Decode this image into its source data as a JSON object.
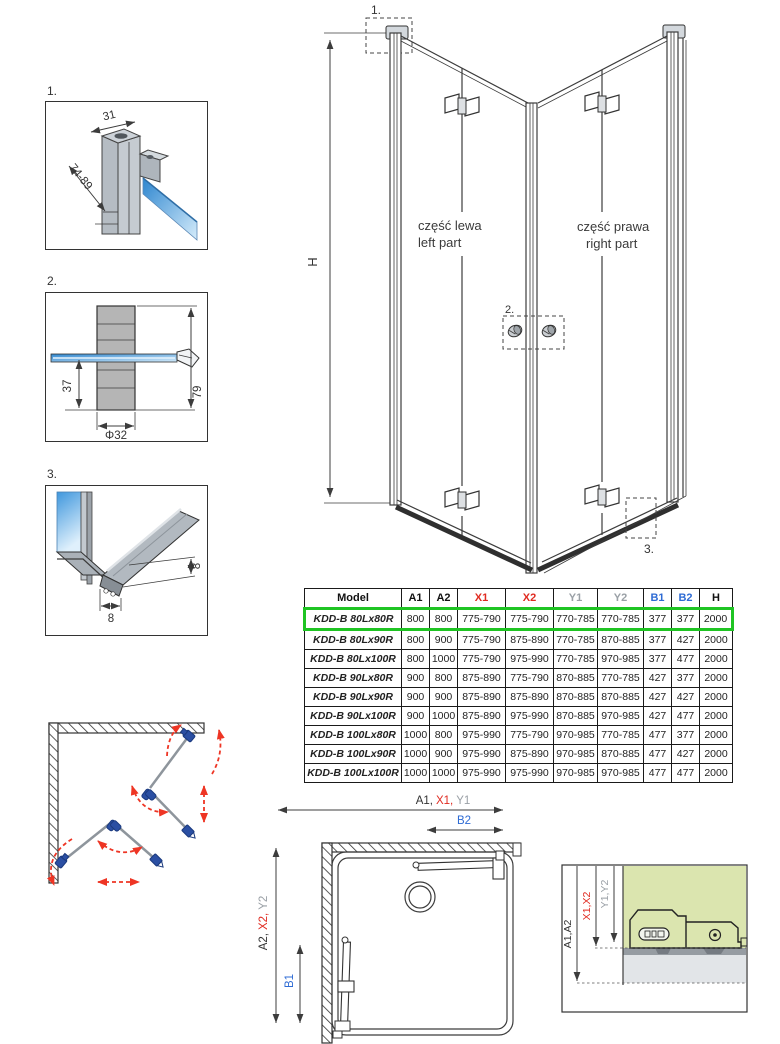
{
  "colors": {
    "red": "#e02a20",
    "blue": "#2e6bd4",
    "gray": "#9aa0a6",
    "highlight_green": "#1fc423",
    "detail_bg_green": "#dbe5af",
    "hinge_blue": "#2b4fa3",
    "arrow_red": "#ee3524",
    "line": "#3c3c3c"
  },
  "detail1": {
    "label": "1.",
    "width_dim": "31",
    "range_dim": "74-89"
  },
  "detail2": {
    "label": "2.",
    "offset_dim": "37",
    "diameter_dim": "Φ32",
    "height_dim": "79"
  },
  "detail3": {
    "label": "3.",
    "height_dim": "8",
    "width_dim": "8"
  },
  "main_drawing": {
    "height_dim": "H",
    "callout_1": "1.",
    "callout_2": "2.",
    "callout_3": "3.",
    "left_part_line1": "część lewa",
    "left_part_line2": "left part",
    "right_part_line1": "część prawa",
    "right_part_line2": "right part"
  },
  "table": {
    "headers": [
      "Model",
      "A1",
      "A2",
      "X1",
      "X2",
      "Y1",
      "Y2",
      "B1",
      "B2",
      "H"
    ],
    "header_colors": [
      "black",
      "black",
      "black",
      "red",
      "red",
      "gray",
      "gray",
      "blue",
      "blue",
      "black"
    ],
    "rows": [
      {
        "highlighted": true,
        "cells": [
          "KDD-B 80Lx80R",
          "800",
          "800",
          "775-790",
          "775-790",
          "770-785",
          "770-785",
          "377",
          "377",
          "2000"
        ]
      },
      {
        "highlighted": false,
        "cells": [
          "KDD-B 80Lx90R",
          "800",
          "900",
          "775-790",
          "875-890",
          "770-785",
          "870-885",
          "377",
          "427",
          "2000"
        ]
      },
      {
        "highlighted": false,
        "cells": [
          "KDD-B 80Lx100R",
          "800",
          "1000",
          "775-790",
          "975-990",
          "770-785",
          "970-985",
          "377",
          "477",
          "2000"
        ]
      },
      {
        "highlighted": false,
        "cells": [
          "KDD-B 90Lx80R",
          "900",
          "800",
          "875-890",
          "775-790",
          "870-885",
          "770-785",
          "427",
          "377",
          "2000"
        ]
      },
      {
        "highlighted": false,
        "cells": [
          "KDD-B 90Lx90R",
          "900",
          "900",
          "875-890",
          "875-890",
          "870-885",
          "870-885",
          "427",
          "427",
          "2000"
        ]
      },
      {
        "highlighted": false,
        "cells": [
          "KDD-B 90Lx100R",
          "900",
          "1000",
          "875-890",
          "975-990",
          "870-885",
          "970-985",
          "427",
          "477",
          "2000"
        ]
      },
      {
        "highlighted": false,
        "cells": [
          "KDD-B 100Lx80R",
          "1000",
          "800",
          "975-990",
          "775-790",
          "970-985",
          "770-785",
          "477",
          "377",
          "2000"
        ]
      },
      {
        "highlighted": false,
        "cells": [
          "KDD-B 100Lx90R",
          "1000",
          "900",
          "975-990",
          "875-890",
          "970-985",
          "870-885",
          "477",
          "427",
          "2000"
        ]
      },
      {
        "highlighted": false,
        "cells": [
          "KDD-B 100Lx100R",
          "1000",
          "1000",
          "975-990",
          "975-990",
          "970-985",
          "970-985",
          "477",
          "477",
          "2000"
        ]
      }
    ]
  },
  "top_view": {
    "a1": "A1,",
    "x1": "X1,",
    "y1": "Y1",
    "b2": "B2",
    "a2": "A2,",
    "x2": "X2,",
    "y2": "Y2",
    "b1": "B1"
  },
  "extension_detail": {
    "a": "A1,A2",
    "x": "X1,X2",
    "y": "Y1,Y2"
  }
}
